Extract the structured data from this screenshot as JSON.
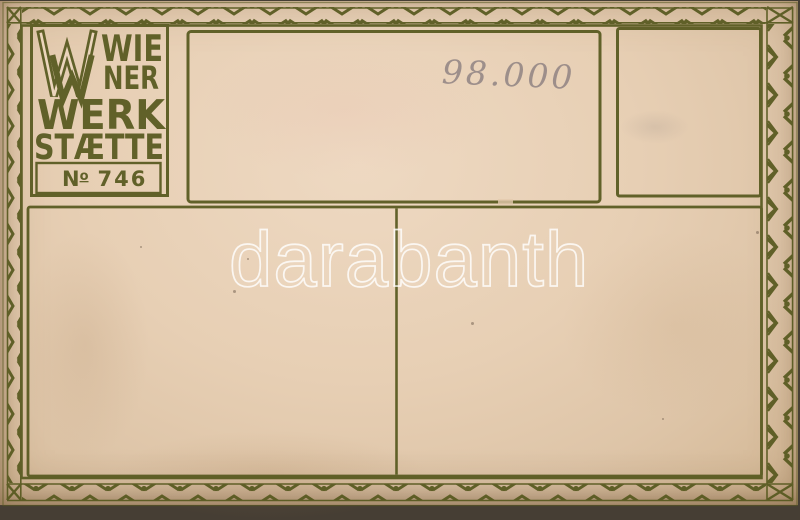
{
  "card": {
    "publisher": {
      "monogram": "WW",
      "name_line1": "WIE",
      "name_line2": "NER",
      "name_line3": "WERK",
      "name_line4": "STÆTTE",
      "number_n": "N",
      "number_o": "o",
      "number_value": "746"
    },
    "annotations": {
      "handwritten_price": "98.000"
    },
    "watermark_text": "darabanth"
  },
  "colors": {
    "ink_olive": "#57591f",
    "paper_light": "#ecd6bd",
    "paper_mid": "#e3c9ad",
    "paper_edge": "#d2b593",
    "pencil_gray": "#80747a",
    "watermark_white": "#ffffff",
    "scan_background": "#463e34"
  }
}
